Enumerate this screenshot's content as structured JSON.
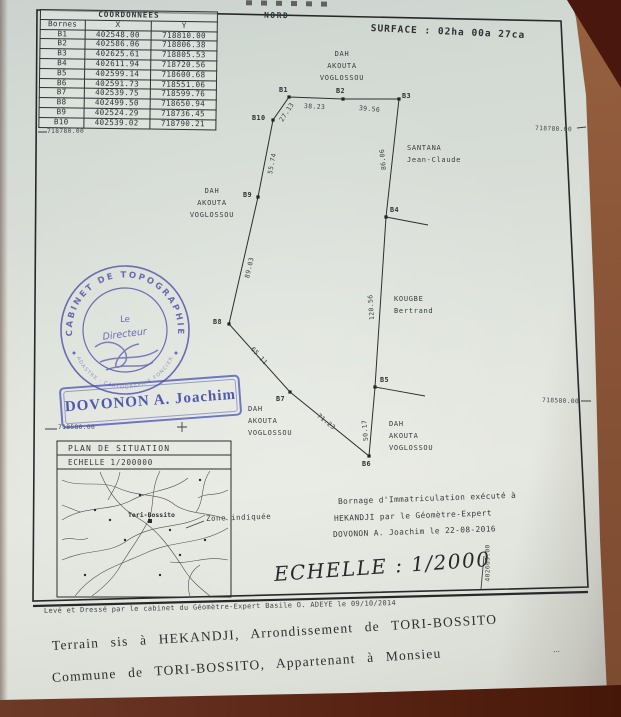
{
  "page": {
    "north": "NORD",
    "surface": "SURFACE :  02ha 00a 27ca",
    "scale_main": "ECHELLE : 1/2000",
    "bornage_lines": [
      "Bornage d'Immatriculation exécuté à",
      "HEKANDJI par le Géomètre-Expert",
      "DOVONON A. Joachim le 22-08-2016"
    ],
    "footer_small": "Levé et Dressé par le cabinet du Géomètre-Expert Basile O. ADEYE  le 09/10/2014",
    "typed_line_1": "Terrain sis à HEKANDJI, Arrondissement de TORI-BOSSITO",
    "typed_line_2": "Commune de TORI-BOSSITO, Appartenant à Monsieu",
    "trailing_dots": "..."
  },
  "coordinates_table": {
    "title": "COORDONNEES",
    "columns": [
      "Bornes",
      "X",
      "Y"
    ],
    "rows": [
      [
        "B1",
        "402548.00",
        "718810.00"
      ],
      [
        "B2",
        "402586.06",
        "718806.38"
      ],
      [
        "B3",
        "402625.61",
        "718805.53"
      ],
      [
        "B4",
        "402611.94",
        "718720.56"
      ],
      [
        "B5",
        "402599.14",
        "718600.68"
      ],
      [
        "B6",
        "402591.73",
        "718551.06"
      ],
      [
        "B7",
        "402539.75",
        "718599.76"
      ],
      [
        "B8",
        "402499.50",
        "718650.94"
      ],
      [
        "B9",
        "402524.29",
        "718736.45"
      ],
      [
        "B10",
        "402539.02",
        "718790.21"
      ]
    ]
  },
  "plot": {
    "vertices": [
      {
        "name": "B1",
        "x": 289,
        "y": 97
      },
      {
        "name": "B2",
        "x": 343,
        "y": 99
      },
      {
        "name": "B3",
        "x": 399,
        "y": 99
      },
      {
        "name": "B4",
        "x": 386,
        "y": 217
      },
      {
        "name": "B5",
        "x": 375,
        "y": 387
      },
      {
        "name": "B6",
        "x": 369,
        "y": 456
      },
      {
        "name": "B7",
        "x": 290,
        "y": 392
      },
      {
        "name": "B8",
        "x": 229,
        "y": 324
      },
      {
        "name": "B9",
        "x": 258,
        "y": 197
      },
      {
        "name": "B10",
        "x": 273,
        "y": 120
      }
    ],
    "vertex_labels": [
      {
        "text": "B1",
        "x": 279,
        "y": 86
      },
      {
        "text": "B2",
        "x": 336,
        "y": 87
      },
      {
        "text": "B3",
        "x": 402,
        "y": 92
      },
      {
        "text": "B4",
        "x": 390,
        "y": 206
      },
      {
        "text": "B5",
        "x": 380,
        "y": 376
      },
      {
        "text": "B6",
        "x": 362,
        "y": 460
      },
      {
        "text": "B7",
        "x": 276,
        "y": 395
      },
      {
        "text": "B8",
        "x": 213,
        "y": 318
      },
      {
        "text": "B9",
        "x": 243,
        "y": 191
      },
      {
        "text": "B10",
        "x": 252,
        "y": 114
      }
    ],
    "edge_labels": [
      {
        "text": "38.23",
        "x": 304,
        "y": 102,
        "rot": 3
      },
      {
        "text": "39.56",
        "x": 359,
        "y": 104,
        "rot": 5
      },
      {
        "text": "86.06",
        "x": 384,
        "y": 166,
        "rot": -96
      },
      {
        "text": "120.56",
        "x": 372,
        "y": 316,
        "rot": -94
      },
      {
        "text": "50.17",
        "x": 366,
        "y": 437,
        "rot": -95
      },
      {
        "text": "71.23",
        "x": 318,
        "y": 411,
        "rot": 39
      },
      {
        "text": "65.11",
        "x": 252,
        "y": 344,
        "rot": 48
      },
      {
        "text": "89.03",
        "x": 247,
        "y": 274,
        "rot": -77
      },
      {
        "text": "55.74",
        "x": 270,
        "y": 170,
        "rot": -79
      },
      {
        "text": "27.13",
        "x": 281,
        "y": 117,
        "rot": -57
      }
    ],
    "edges": [
      [
        "B1",
        "B2",
        "38.23"
      ],
      [
        "B2",
        "B3",
        "39.56"
      ],
      [
        "B3",
        "B4",
        "86.06"
      ],
      [
        "B4",
        "B5",
        "120.56"
      ],
      [
        "B5",
        "B6",
        "50.17"
      ],
      [
        "B6",
        "B7",
        "71.23"
      ],
      [
        "B7",
        "B8",
        "65.11"
      ],
      [
        "B8",
        "B9",
        "89.03"
      ],
      [
        "B9",
        "B10",
        "55.74"
      ],
      [
        "B10",
        "B1",
        "27.13"
      ]
    ]
  },
  "neighbors": [
    {
      "lines": [
        "DAH",
        "AKOUTA",
        "VOGLOSSOU"
      ],
      "x": 342,
      "y": 48,
      "align": "center"
    },
    {
      "lines": [
        "SANTANA",
        "Jean-Claude"
      ],
      "x": 407,
      "y": 142,
      "align": "left"
    },
    {
      "lines": [
        "DAH",
        "AKOUTA",
        "VOGLOSSOU"
      ],
      "x": 212,
      "y": 185,
      "align": "center"
    },
    {
      "lines": [
        "KOUGBE",
        "Bertrand"
      ],
      "x": 394,
      "y": 293,
      "align": "left"
    },
    {
      "lines": [
        "DAH",
        "AKOUTA",
        "VOGLOSSOU"
      ],
      "x": 248,
      "y": 403,
      "align": "left"
    },
    {
      "lines": [
        "DAH",
        "AKOUTA",
        "VOGLOSSOU"
      ],
      "x": 389,
      "y": 418,
      "align": "left"
    }
  ],
  "grid_labels": [
    {
      "text": "718780.00",
      "x": 47,
      "y": 128,
      "rot": 0
    },
    {
      "text": "718780.00",
      "x": 535,
      "y": 125,
      "rot": 2
    },
    {
      "text": "718580.00",
      "x": 58,
      "y": 424,
      "rot": 0
    },
    {
      "text": "718580.00",
      "x": 542,
      "y": 397,
      "rot": 2
    },
    {
      "text": "402665.00",
      "x": 488,
      "y": 578,
      "rot": -90
    }
  ],
  "inset": {
    "title": "PLAN DE SITUATION",
    "scale": "ECHELLE  1/200000",
    "town": "Tori-Bossito",
    "zone_label": "Zone indiquée"
  },
  "stamps": {
    "round_top": "CABINET DE TOPOGRAPHIE",
    "round_bottom": "CADASTRE · CARTOGRAPHIE FONCIERE",
    "round_line1": "Le",
    "round_line2": "Directeur",
    "rect": "DOVONON A. Joachim"
  },
  "colors": {
    "stamp_blue": "#4b49a6",
    "ink": "#2e3234",
    "paper": "#dce1da",
    "desk_brown": "#8a5538",
    "desk_maroon": "#4a170e"
  }
}
